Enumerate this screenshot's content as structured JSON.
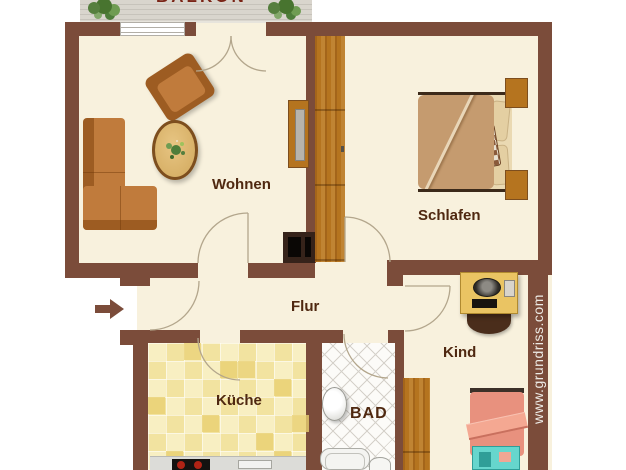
{
  "labels": {
    "wohnen": "Wohnen",
    "schlafen": "Schlafen",
    "flur": "Flur",
    "kueche": "Küche",
    "bad": "BAD",
    "kind": "Kind",
    "balkon": "BALKON"
  },
  "watermark": "www.grundriss.com",
  "palette": {
    "wall": "#7b4c3a",
    "floor": "#f8f1dd",
    "outside": "#ffffff",
    "arc": "#b3a68c",
    "label": "#4f2810",
    "balkon-label": "#7a2416",
    "watermark": "#edebe6",
    "wood": "#b5741f",
    "wood-dark": "#a4651a",
    "sofa": "#c07b3c",
    "sofa-dark": "#9d5c22",
    "table-wood": "#d8b168",
    "table-rim": "#7d4e1e",
    "tile-a": "#f2e3a0",
    "tile-b": "#f8efc2",
    "tile-dark": "#e9cf72",
    "bad-floor": "#fcfbf8",
    "bad-line": "#d5d1ca",
    "balcony": "#d9d5cd",
    "balcony-line": "#c7c3bb",
    "plant": "#567f3e",
    "bed-blanket": "#c59b6f",
    "bed-sheet": "#ead9b2",
    "kind-bed": "#e8917e",
    "teal": "#66d6cd",
    "teal-dark": "#2f9e98",
    "desk": "#eac463",
    "chair-dark": "#4a2d1b",
    "tv-dark": "#36231a",
    "counter": "#dcdcd8",
    "stove": "#141210",
    "burner": "#b02315",
    "window-line": "#b2aea6",
    "arrow": "#7b4c3a"
  }
}
